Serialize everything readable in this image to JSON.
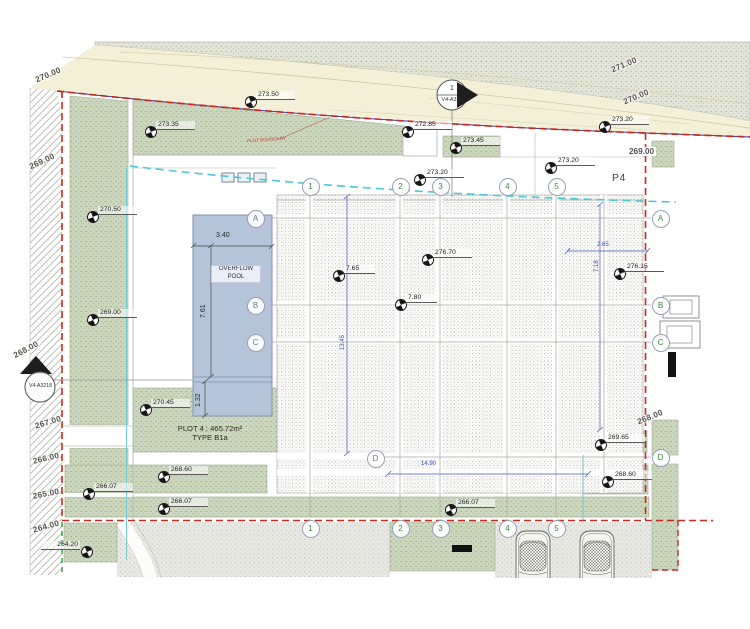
{
  "title_labels": {
    "p4": "P4",
    "plot_line1": "PLOT 4 : 465.72m²",
    "plot_line2": "TYPE B1a",
    "pool_line1": "OVERFLOW",
    "pool_line2": "POOL",
    "boundary_note": "PLOT BOUNDARY"
  },
  "section_markers": {
    "top": {
      "number": "1",
      "ref": "V4-A321"
    },
    "left": {
      "ref": "V4-A3218"
    }
  },
  "dimensions": {
    "pool_w": "3.40",
    "pool_h": "7.61",
    "pool_basin": "1.32",
    "deck_w": "2.65",
    "deck_h": "7.18",
    "bay_h": "13.45",
    "bay_w": "14.90"
  },
  "grid_bubbles": {
    "top": [
      {
        "label": "1",
        "x": 310,
        "y": 186
      },
      {
        "label": "2",
        "x": 400,
        "y": 186
      },
      {
        "label": "3",
        "x": 440,
        "y": 186
      },
      {
        "label": "4",
        "x": 507,
        "y": 186
      },
      {
        "label": "5",
        "x": 556,
        "y": 186
      }
    ],
    "bottom": [
      {
        "label": "1",
        "x": 310,
        "y": 528
      },
      {
        "label": "2",
        "x": 400,
        "y": 528
      },
      {
        "label": "3",
        "x": 440,
        "y": 528
      },
      {
        "label": "4",
        "x": 507,
        "y": 528
      },
      {
        "label": "5",
        "x": 556,
        "y": 528
      }
    ],
    "left": [
      {
        "label": "A",
        "x": 255,
        "y": 218
      },
      {
        "label": "B",
        "x": 255,
        "y": 305
      },
      {
        "label": "C",
        "x": 255,
        "y": 342
      },
      {
        "label": "D",
        "x": 375,
        "y": 458
      }
    ],
    "right": [
      {
        "label": "A",
        "x": 660,
        "y": 218
      },
      {
        "label": "B",
        "x": 660,
        "y": 305
      },
      {
        "label": "C",
        "x": 660,
        "y": 342
      },
      {
        "label": "D",
        "x": 660,
        "y": 457
      }
    ]
  },
  "spot_elevations": [
    {
      "v": "273.35",
      "x": 150,
      "y": 131
    },
    {
      "v": "273.50",
      "x": 250,
      "y": 101
    },
    {
      "v": "272.85",
      "x": 407,
      "y": 131
    },
    {
      "v": "273.45",
      "x": 455,
      "y": 147
    },
    {
      "v": "273.20",
      "x": 419,
      "y": 179
    },
    {
      "v": "273.20",
      "x": 550,
      "y": 167
    },
    {
      "v": "273.20",
      "x": 604,
      "y": 126
    },
    {
      "v": "270.50",
      "x": 92,
      "y": 216
    },
    {
      "v": "269.00",
      "x": 92,
      "y": 319
    },
    {
      "v": "270.45",
      "x": 145,
      "y": 409
    },
    {
      "v": "268.60",
      "x": 163,
      "y": 476
    },
    {
      "v": "266.07",
      "x": 88,
      "y": 493
    },
    {
      "v": "266.07",
      "x": 163,
      "y": 508
    },
    {
      "v": "266.07",
      "x": 450,
      "y": 509
    },
    {
      "v": "269.65",
      "x": 600,
      "y": 444
    },
    {
      "v": "268.60",
      "x": 607,
      "y": 481
    },
    {
      "v": "264.20",
      "x": 86,
      "y": 551,
      "flip": true
    },
    {
      "v": "276.70",
      "x": 427,
      "y": 259
    },
    {
      "v": "7.65",
      "x": 338,
      "y": 275
    },
    {
      "v": "7.80",
      "x": 400,
      "y": 304
    },
    {
      "v": "276.15",
      "x": 619,
      "y": 273
    }
  ],
  "contour_labels": [
    {
      "v": "270.00",
      "x": 34,
      "y": 76,
      "r": -23
    },
    {
      "v": "269.00",
      "x": 28,
      "y": 163,
      "r": -25
    },
    {
      "v": "268.00",
      "x": 12,
      "y": 352,
      "r": -28
    },
    {
      "v": "267.00",
      "x": 34,
      "y": 422,
      "r": -17
    },
    {
      "v": "266.00",
      "x": 32,
      "y": 457,
      "r": -13
    },
    {
      "v": "265.00",
      "x": 32,
      "y": 492,
      "r": -11
    },
    {
      "v": "264.00",
      "x": 32,
      "y": 526,
      "r": -16
    },
    {
      "v": "271.00",
      "x": 610,
      "y": 66,
      "r": -23
    },
    {
      "v": "270.00",
      "x": 622,
      "y": 98,
      "r": -23
    },
    {
      "v": "268.00",
      "x": 636,
      "y": 418,
      "r": -22
    }
  ],
  "right_contour_label": "269.00",
  "colors": {
    "boundary_red": "#c92a20",
    "boundary_blue": "#2b3db0",
    "utility_cyan": "#4cc7d4",
    "landscape_green": "#cbd7bd",
    "pool_blue": "#b6c4da",
    "dimension_blue": "#3f4cc0"
  }
}
